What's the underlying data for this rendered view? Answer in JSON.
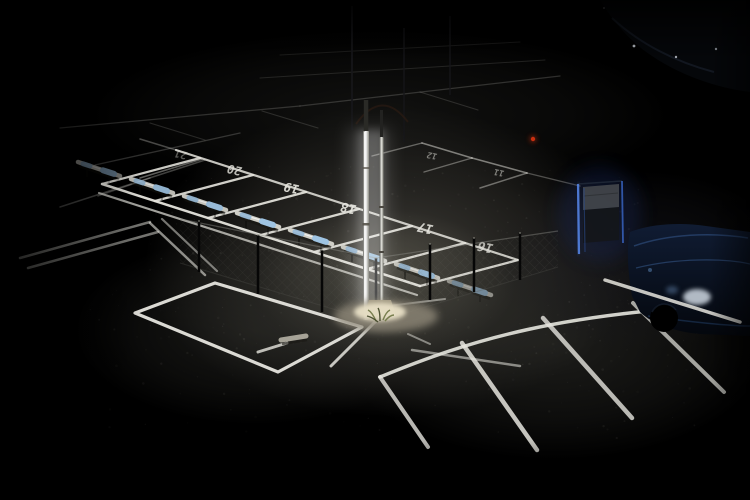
{
  "scene": {
    "type": "photograph",
    "description": "Dark night-time parking lot lit by a single slim light pole; white stall markings, painted stall numbers, wheel stops with blue sleeves, low mesh fence, blue-edged sign, dark blue parked car at right edge."
  },
  "colors": {
    "background": "#000000",
    "paint_white": "#e6e5de",
    "asphalt_light": "#46443e",
    "pole_white": "#ffffff",
    "wheel_stop_metal": "#cfcec6",
    "wheel_stop_blue": "#9fc4e2",
    "wheel_stop_blue2": "#8ab2d4",
    "sign_blue": "#5585e8",
    "car_blue_dark": "#0d1526",
    "car_highlight": "#cfd8e2",
    "red_light": "#d03010",
    "grass_green": "#6d7442",
    "mesh_grey": "#6b6b64"
  },
  "stall_numbers": [
    {
      "label": "21",
      "x": 182,
      "y": 151,
      "size": 10.5,
      "opacity": 0.38
    },
    {
      "label": "20",
      "x": 236,
      "y": 166,
      "size": 12,
      "opacity": 0.8
    },
    {
      "label": "19",
      "x": 293,
      "y": 184,
      "size": 12.5,
      "opacity": 0.92
    },
    {
      "label": "18",
      "x": 350,
      "y": 204,
      "size": 13,
      "opacity": 0.92
    },
    {
      "label": "17",
      "x": 427,
      "y": 224,
      "size": 13,
      "opacity": 0.88
    },
    {
      "label": "16",
      "x": 487,
      "y": 243,
      "size": 13,
      "opacity": 0.75
    },
    {
      "label": "12",
      "x": 433,
      "y": 153,
      "size": 8.5,
      "opacity": 0.5
    },
    {
      "label": "11",
      "x": 500,
      "y": 170,
      "size": 8.5,
      "opacity": 0.5
    }
  ],
  "number_rotation": 192,
  "number_skew": -10,
  "light_pools": [
    {
      "cx": 390,
      "cy": 262,
      "rx": 245,
      "ry": 155,
      "color": "#46443e",
      "opacity": 0.88
    },
    {
      "cx": 385,
      "cy": 285,
      "rx": 130,
      "ry": 75,
      "color": "#555349",
      "opacity": 0.7
    },
    {
      "cx": 555,
      "cy": 345,
      "rx": 215,
      "ry": 115,
      "color": "#30302c",
      "opacity": 0.6
    },
    {
      "cx": 255,
      "cy": 330,
      "rx": 180,
      "ry": 95,
      "color": "#2e2e2a",
      "opacity": 0.55
    },
    {
      "cx": 380,
      "cy": 115,
      "rx": 290,
      "ry": 85,
      "color": "#232320",
      "opacity": 0.5
    },
    {
      "cx": 640,
      "cy": 260,
      "rx": 150,
      "ry": 90,
      "color": "#1c1c22",
      "opacity": 0.5
    }
  ],
  "dim_lines": [
    [
      60,
      128,
      300,
      106,
      1.2,
      0.18
    ],
    [
      300,
      106,
      560,
      76,
      1.2,
      0.18
    ],
    [
      150,
      123,
      205,
      140,
      1.1,
      0.15
    ],
    [
      262,
      111,
      318,
      128,
      1.1,
      0.15
    ],
    [
      420,
      92,
      478,
      110,
      1.1,
      0.15
    ],
    [
      280,
      55,
      520,
      42,
      1.0,
      0.1
    ],
    [
      260,
      78,
      545,
      60,
      1.0,
      0.12
    ],
    [
      140,
      139,
      176,
      150,
      1.5,
      0.3
    ],
    [
      95,
      165,
      240,
      133,
      1.3,
      0.2
    ],
    [
      60,
      207,
      205,
      160,
      1.5,
      0.28
    ],
    [
      150,
      178,
      98,
      196,
      1.4,
      0.25
    ],
    [
      140,
      178,
      202,
      159,
      1.6,
      0.4
    ],
    [
      422,
      143,
      472,
      158,
      1.6,
      0.5
    ],
    [
      472,
      158,
      527,
      173,
      1.6,
      0.5
    ],
    [
      422,
      143,
      372,
      156,
      1.4,
      0.38
    ],
    [
      472,
      158,
      424,
      172,
      1.4,
      0.38
    ],
    [
      527,
      173,
      480,
      188,
      1.5,
      0.42
    ],
    [
      527,
      173,
      580,
      186,
      1.4,
      0.3
    ]
  ],
  "bright_lines": [
    [
      176,
      150,
      518,
      260,
      2.2,
      0.85
    ],
    [
      200,
      158,
      102,
      184,
      2.2,
      0.88
    ],
    [
      253,
      175,
      155,
      201,
      2.2,
      0.9
    ],
    [
      306,
      192,
      208,
      218,
      2.3,
      0.92
    ],
    [
      359,
      209,
      261,
      235,
      2.3,
      0.92
    ],
    [
      412,
      226,
      314,
      252,
      2.3,
      0.92
    ],
    [
      465,
      243,
      367,
      269,
      2.3,
      0.9
    ],
    [
      518,
      260,
      420,
      286,
      2.3,
      0.88
    ],
    [
      102,
      184,
      420,
      286,
      2.5,
      0.95
    ],
    [
      99,
      193,
      417,
      295,
      2.2,
      0.7
    ],
    [
      20,
      258,
      150,
      222,
      2.5,
      0.5
    ],
    [
      28,
      268,
      158,
      232,
      2.5,
      0.5
    ],
    [
      150,
      223,
      205,
      275,
      2.5,
      0.6
    ],
    [
      162,
      219,
      217,
      271,
      2.2,
      0.5
    ],
    [
      408,
      334,
      430,
      344,
      2.0,
      0.5
    ],
    [
      412,
      350,
      520,
      366,
      2.5,
      0.55
    ],
    [
      380,
      307,
      445,
      299,
      2.0,
      0.5
    ]
  ],
  "pavement_box": {
    "outline": "215,283 362,327 278,372 135,313",
    "dash": [
      258,
      352,
      287,
      343,
      3,
      0.8
    ],
    "pipe": [
      281,
      340,
      306,
      336
    ],
    "diagonal": [
      377,
      320,
      331,
      366,
      3,
      0.85
    ]
  },
  "stripe_paths": [
    {
      "d": "M380,377 C470,340 560,312 748,304",
      "w": 3.5,
      "op": 0.9
    },
    {
      "d": "M380,377 L428,447",
      "w": 4.0,
      "op": 0.8
    },
    {
      "d": "M462,343 L537,450",
      "w": 4.5,
      "op": 0.85
    },
    {
      "d": "M543,318 L632,418",
      "w": 4.5,
      "op": 0.8
    },
    {
      "d": "M633,303 L724,392",
      "w": 4.0,
      "op": 0.7
    }
  ],
  "car_front_line": {
    "d": "M605,280 L740,322",
    "w": 3.5,
    "op": 0.85
  },
  "fence": {
    "mesh_left": "180,219 376,258 376,322 180,263",
    "mesh_right": "376,258 558,231 558,267 376,322",
    "rail_top": [
      [
        180,
        219,
        376,
        258
      ],
      [
        376,
        258,
        558,
        231
      ]
    ],
    "rail_bottom": [
      [
        180,
        263,
        376,
        322
      ],
      [
        376,
        322,
        558,
        267
      ]
    ],
    "posts": [
      [
        199,
        221,
        272
      ],
      [
        258,
        235,
        294
      ],
      [
        322,
        250,
        312
      ],
      [
        376,
        258,
        322
      ],
      [
        430,
        244,
        300
      ],
      [
        474,
        238,
        292
      ],
      [
        520,
        233,
        280
      ]
    ]
  },
  "wheel_stops": [
    {
      "cx": 99,
      "cy": 169,
      "op": 0.55
    },
    {
      "cx": 152,
      "cy": 186,
      "op": 0.9
    },
    {
      "cx": 205,
      "cy": 203,
      "op": 0.95
    },
    {
      "cx": 258,
      "cy": 220,
      "op": 1.0
    },
    {
      "cx": 311,
      "cy": 237,
      "op": 1.0
    },
    {
      "cx": 364,
      "cy": 254,
      "op": 0.95
    },
    {
      "cx": 417,
      "cy": 271,
      "op": 0.9
    },
    {
      "cx": 470,
      "cy": 288,
      "op": 0.6
    }
  ],
  "poles": {
    "dim_uprights": [
      [
        352,
        6,
        130,
        2
      ],
      [
        404,
        28,
        142,
        1.5
      ],
      [
        450,
        16,
        95,
        1.5
      ]
    ],
    "arch": "M356,124 Q382,88 408,122",
    "main": {
      "x": 363,
      "y": 131,
      "w": 6,
      "h": 189
    },
    "second": {
      "x": 379.5,
      "y": 137,
      "w": 4,
      "h": 176
    }
  },
  "sign": {
    "panel": "583,187 619,184 619,207 583,210",
    "body": "583,210 619,207 619,240 583,243",
    "left_edge": [
      578,
      184,
      579,
      254
    ],
    "inner_edge": [
      584,
      188,
      585,
      252
    ],
    "right_edge": [
      622,
      181,
      623,
      243
    ],
    "top_edge": [
      578,
      184,
      622,
      181
    ]
  },
  "red_light": {
    "cx": 533,
    "cy": 139,
    "r": 2.2
  }
}
